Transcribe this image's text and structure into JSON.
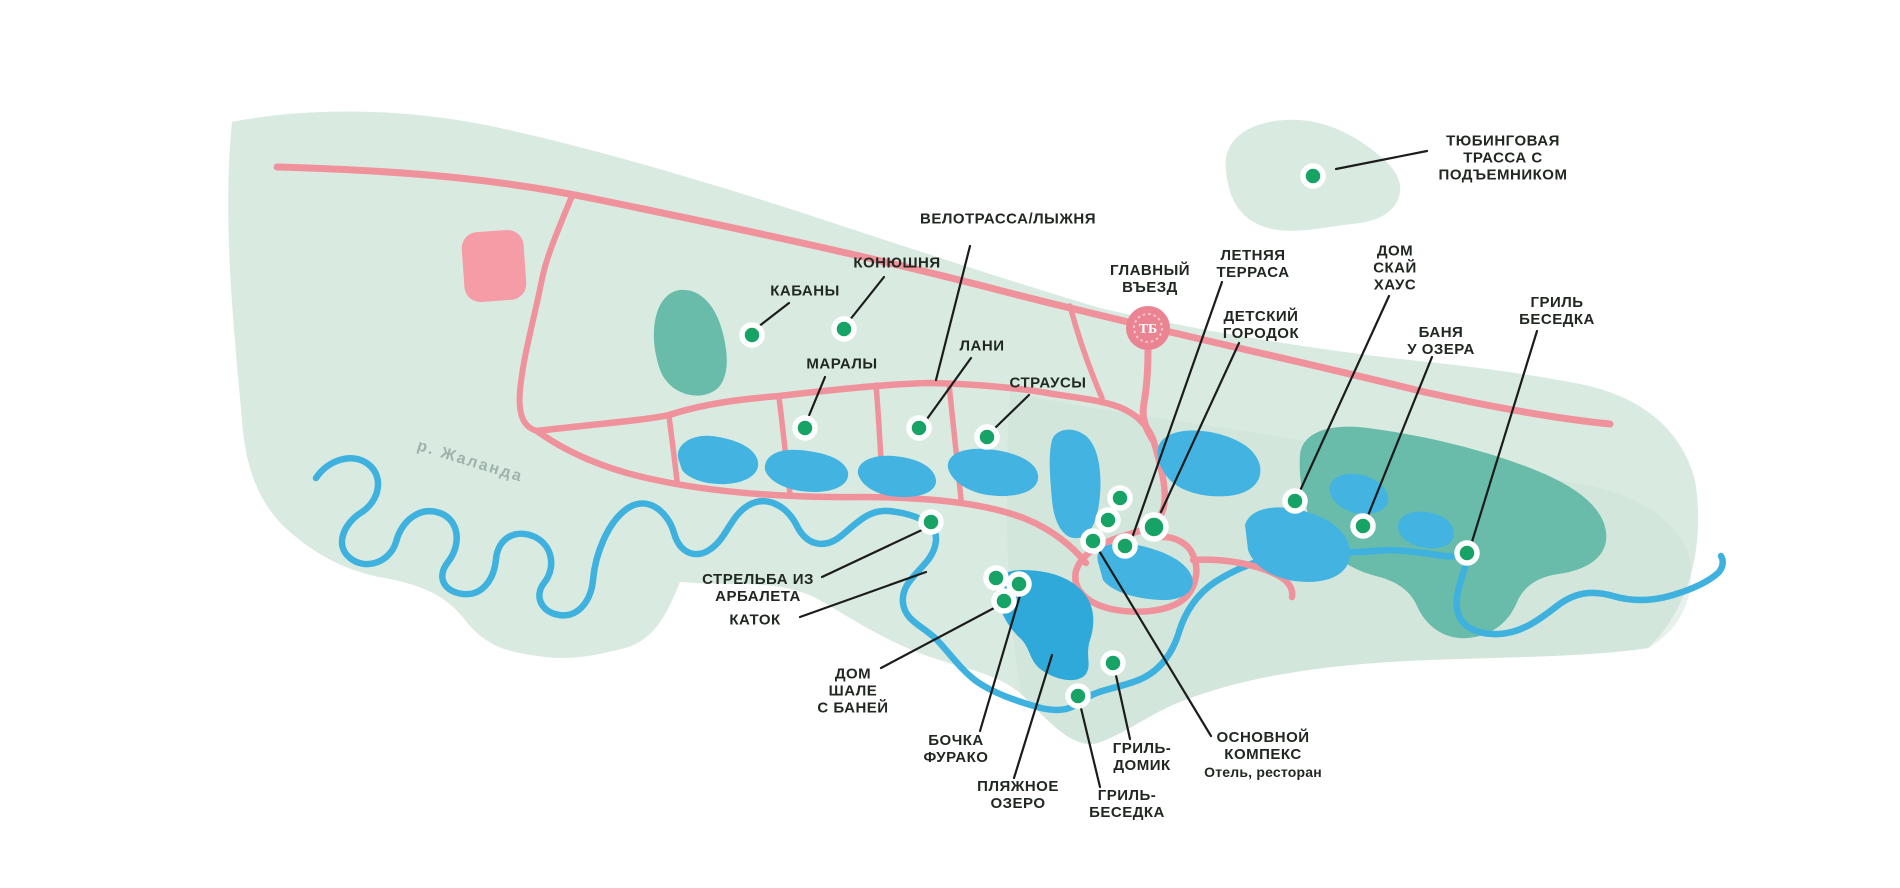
{
  "map": {
    "background_color": "#ffffff",
    "colors": {
      "park": "#d9ebe1",
      "park_shade": "#cbe0d5",
      "forest": "#68bca9",
      "lake": "#43b4e1",
      "beach_lake": "#2fa8da",
      "river": "#3eb1de",
      "road": "#f0929c",
      "building_square": "#f69ca6",
      "entrance_badge": "#eb8492",
      "entrance_ornament": "#f8c6cc",
      "marker": "#17a266",
      "marker_ring": "#ffffff",
      "leader": "#1c1c1c",
      "label": "#212721",
      "river_label": "#9fb2ab"
    },
    "river_label": {
      "text": "р. Жаланда",
      "x": 470,
      "y": 462,
      "rotation_deg": 17
    },
    "entrance": {
      "monogram": "ТБ",
      "x": 1148,
      "y": 328
    },
    "pois": [
      {
        "id": "tubing-track",
        "label": "ТЮБИНГОВАЯ\nТРАССА С\nПОДЪЕМНИКОМ",
        "lx": 1503,
        "ly": 158,
        "line": [
          1427,
          151,
          1336,
          169
        ],
        "dot": [
          1313,
          176,
          10
        ]
      },
      {
        "id": "velotrassa",
        "label": "ВЕЛОТРАССА/ЛЫЖНЯ",
        "lx": 1008,
        "ly": 219,
        "line": [
          970,
          246,
          936,
          380
        ],
        "dot": null
      },
      {
        "id": "konyushnya",
        "label": "КОНЮШНЯ",
        "lx": 897,
        "ly": 263,
        "line": [
          884,
          277,
          849,
          321
        ],
        "dot": [
          844,
          329,
          10
        ]
      },
      {
        "id": "kabany",
        "label": "КАБАНЫ",
        "lx": 805,
        "ly": 291,
        "line": [
          789,
          303,
          758,
          327
        ],
        "dot": [
          752,
          335,
          10
        ]
      },
      {
        "id": "maraly",
        "label": "МАРАЛЫ",
        "lx": 842,
        "ly": 364,
        "line": [
          825,
          377,
          808,
          418
        ],
        "dot": [
          805,
          428,
          10
        ]
      },
      {
        "id": "lani",
        "label": "ЛАНИ",
        "lx": 982,
        "ly": 346,
        "line": [
          971,
          358,
          927,
          419
        ],
        "dot": [
          919,
          428,
          10
        ]
      },
      {
        "id": "strausy",
        "label": "СТРАУСЫ",
        "lx": 1048,
        "ly": 383,
        "line": [
          1029,
          395,
          995,
          428
        ],
        "dot": [
          987,
          437,
          10
        ]
      },
      {
        "id": "glavny-vezd",
        "label": "ГЛАВНЫЙ\nВЪЕЗД",
        "lx": 1150,
        "ly": 279,
        "line": null,
        "dot": null
      },
      {
        "id": "letnyaya-terrasa",
        "label": "ЛЕТНЯЯ\nТЕРРАСА",
        "lx": 1253,
        "ly": 264,
        "line": [
          1222,
          282,
          1132,
          538
        ],
        "dot": [
          1125,
          546,
          10
        ]
      },
      {
        "id": "detsky-gorodok",
        "label": "ДЕТСКИЙ\nГОРОДОК",
        "lx": 1261,
        "ly": 325,
        "line": [
          1239,
          343,
          1161,
          512
        ],
        "dot": [
          1154,
          527,
          12
        ]
      },
      {
        "id": "dom-sky-house",
        "label": "ДОМ\nСКАЙ\nХАУС",
        "lx": 1395,
        "ly": 268,
        "line": [
          1389,
          296,
          1299,
          493
        ],
        "dot": [
          1295,
          501,
          10
        ]
      },
      {
        "id": "banya-u-ozera",
        "label": "БАНЯ\nУ ОЗЕРА",
        "lx": 1441,
        "ly": 341,
        "line": [
          1432,
          357,
          1367,
          518
        ],
        "dot": [
          1363,
          526,
          10
        ]
      },
      {
        "id": "gril-besedka-east",
        "label": "ГРИЛЬ\nБЕСЕДКА",
        "lx": 1557,
        "ly": 311,
        "line": [
          1537,
          331,
          1471,
          545
        ],
        "dot": [
          1467,
          553,
          10
        ]
      },
      {
        "id": "strelba-iz-arbaleta",
        "label": "СТРЕЛЬБА ИЗ\nАРБАЛЕТА",
        "lx": 758,
        "ly": 588,
        "line": [
          822,
          577,
          924,
          529
        ],
        "dot": [
          931,
          522,
          10
        ]
      },
      {
        "id": "katok",
        "label": "КАТОК",
        "lx": 755,
        "ly": 620,
        "line": [
          800,
          617,
          926,
          572
        ],
        "dot": null
      },
      {
        "id": "dom-shale-s-baney",
        "label": "ДОМ\nШАЛЕ\nС БАНЕЙ",
        "lx": 853,
        "ly": 691,
        "line": [
          881,
          668,
          996,
          607
        ],
        "dot": [
          1004,
          601,
          10
        ]
      },
      {
        "id": "bochka-furako",
        "label": "БОЧКА\nФУРАКО",
        "lx": 956,
        "ly": 749,
        "line": [
          980,
          731,
          1021,
          592
        ],
        "dot": [
          1019,
          584,
          10
        ]
      },
      {
        "id": "plyazhnoe-ozero",
        "label": "ПЛЯЖНОЕ\nОЗЕРО",
        "lx": 1018,
        "ly": 795,
        "line": [
          1014,
          778,
          1052,
          655
        ],
        "dot": null
      },
      {
        "id": "gril-besedka-south",
        "label": "ГРИЛЬ-\nБЕСЕДКА",
        "lx": 1127,
        "ly": 804,
        "line": [
          1100,
          787,
          1080,
          704
        ],
        "dot": [
          1078,
          696,
          10
        ]
      },
      {
        "id": "gril-domik",
        "label": "ГРИЛЬ-\nДОМИК",
        "lx": 1142,
        "ly": 757,
        "line": [
          1130,
          739,
          1115,
          671
        ],
        "dot": [
          1113,
          663,
          10
        ]
      },
      {
        "id": "osnovnoy-kompeks",
        "label": "ОСНОВНОЙ\nКОМПЕКС",
        "sub": "Отель, ресторан",
        "lx": 1263,
        "ly": 755,
        "line": [
          1211,
          736,
          1098,
          549
        ],
        "dot": [
          1093,
          541,
          10
        ]
      }
    ],
    "unlabeled_markers": [
      {
        "x": 1120,
        "y": 498
      },
      {
        "x": 1108,
        "y": 520
      },
      {
        "x": 996,
        "y": 578
      }
    ]
  }
}
